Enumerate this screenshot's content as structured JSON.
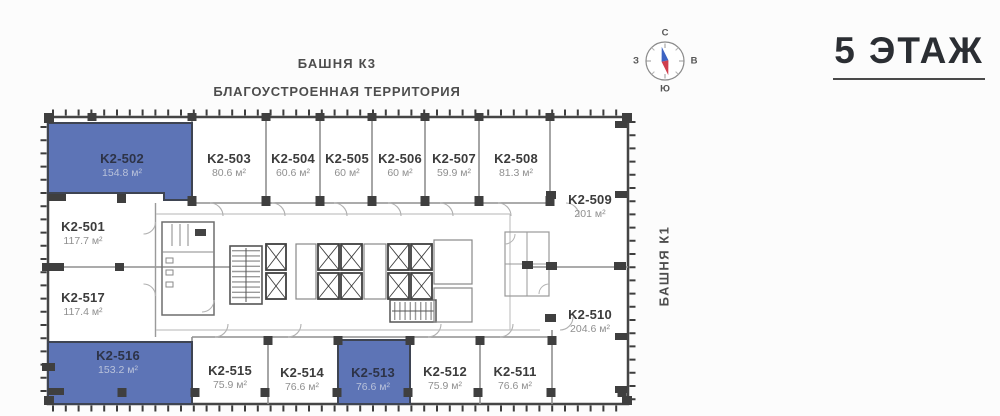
{
  "title": {
    "floor": "5 ЭТАЖ"
  },
  "site_labels": {
    "tower_k3": "БАШНЯ К3",
    "territory": "БЛАГОУСТРОЕННАЯ ТЕРРИТОРИЯ",
    "tower_k1": "БАШНЯ К1"
  },
  "compass": {
    "north": "С",
    "east": "В",
    "south": "Ю",
    "west": "З"
  },
  "colors": {
    "available_fill": "#5d74b6",
    "wall": "#3f3f3f",
    "needle_north": "#3c63c2",
    "needle_south": "#cf3f4e"
  },
  "units": [
    {
      "id": "K2-501",
      "area": "117.7 м²",
      "available": false
    },
    {
      "id": "K2-502",
      "area": "154.8 м²",
      "available": true
    },
    {
      "id": "K2-503",
      "area": "80.6 м²",
      "available": false
    },
    {
      "id": "K2-504",
      "area": "60.6 м²",
      "available": false
    },
    {
      "id": "K2-505",
      "area": "60 м²",
      "available": false
    },
    {
      "id": "K2-506",
      "area": "60 м²",
      "available": false
    },
    {
      "id": "K2-507",
      "area": "59.9 м²",
      "available": false
    },
    {
      "id": "K2-508",
      "area": "81.3 м²",
      "available": false
    },
    {
      "id": "K2-509",
      "area": "201 м²",
      "available": false
    },
    {
      "id": "K2-510",
      "area": "204.6 м²",
      "available": false
    },
    {
      "id": "K2-511",
      "area": "76.6 м²",
      "available": false
    },
    {
      "id": "K2-512",
      "area": "75.9 м²",
      "available": false
    },
    {
      "id": "K2-513",
      "area": "76.6 м²",
      "available": true
    },
    {
      "id": "K2-514",
      "area": "76.6 м²",
      "available": false
    },
    {
      "id": "K2-515",
      "area": "75.9 м²",
      "available": false
    },
    {
      "id": "K2-516",
      "area": "153.2 м²",
      "available": true
    },
    {
      "id": "K2-517",
      "area": "117.4 м²",
      "available": false
    }
  ]
}
